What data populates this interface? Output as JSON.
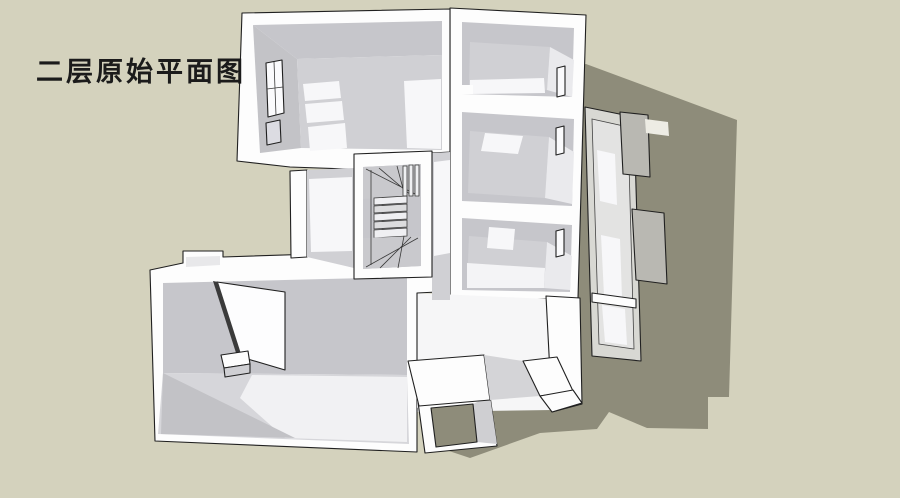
{
  "title": {
    "text": "二层原始平面图"
  },
  "scene": {
    "type": "sketchup-3d-floorplan-render",
    "view": "axonometric-top",
    "elements": [
      "top-left-room",
      "top-right-room",
      "middle-right-room",
      "bottom-right-room",
      "bottom-left-room",
      "staircase",
      "hallway",
      "side-balcony",
      "exterior-steps",
      "cast-shadow"
    ]
  },
  "colors": {
    "background": "#d4d2bd",
    "shadow": "#8e8c7a",
    "wall_white": "#fdfdfd",
    "wall_gray": "#c6c6cb",
    "wall_gray_dark": "#c3c3c7",
    "floor_gray": "#d0d0d4",
    "floor_lit": "#f7f7f9",
    "corner_highlight": "#eaeaed",
    "balcony_frame": "#d8d8d3",
    "balcony_floor": "#e3e3e2",
    "protrusion": "#b9b8b2",
    "outline": "#202020",
    "title_color": "#1b1b1b"
  }
}
